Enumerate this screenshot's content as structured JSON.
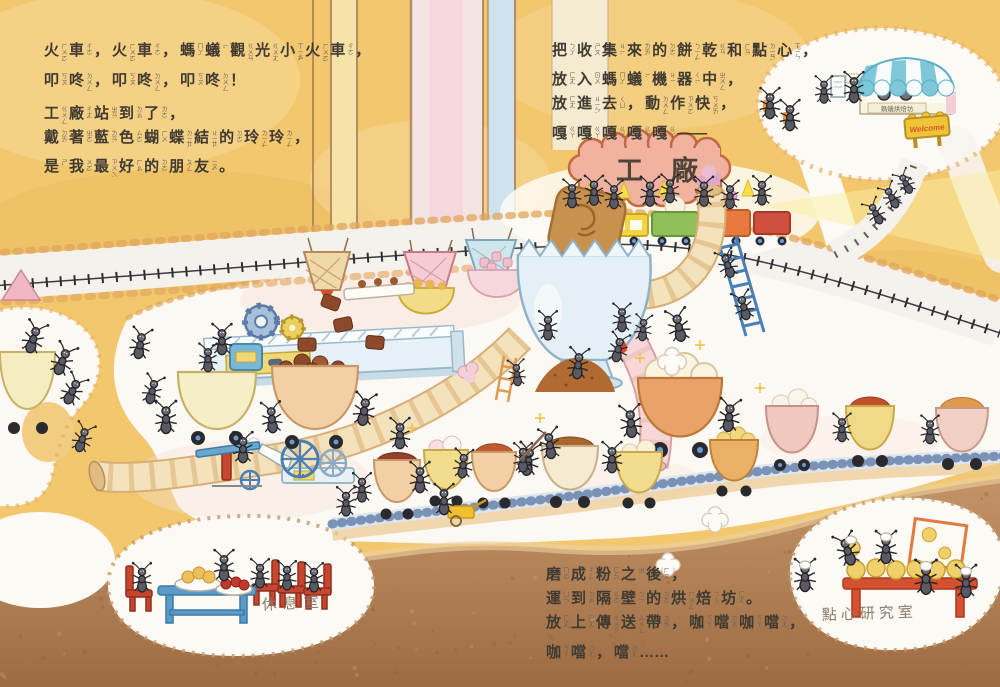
{
  "story": {
    "block1": {
      "lines": [
        [
          [
            "火",
            "ㄏㄨㄛˇ"
          ],
          [
            "車",
            "ㄔㄜ"
          ],
          [
            "，",
            ""
          ],
          [
            "火",
            "ㄏㄨㄛˇ"
          ],
          [
            "車",
            "ㄔㄜ"
          ],
          [
            "，",
            ""
          ],
          [
            "螞",
            "ㄇㄚˇ"
          ],
          [
            "蟻",
            "ㄧˇ"
          ],
          [
            "觀",
            "ㄍㄨㄢ"
          ],
          [
            "光",
            "ㄍㄨㄤ"
          ],
          [
            "小",
            "ㄒㄧㄠˇ"
          ],
          [
            "火",
            "ㄏㄨㄛˇ"
          ],
          [
            "車",
            "ㄔㄜ"
          ],
          [
            "，",
            ""
          ]
        ],
        [
          [
            "叩",
            "ㄎㄡˋ"
          ],
          [
            "咚",
            "ㄉㄨㄥ"
          ],
          [
            "，",
            ""
          ],
          [
            "叩",
            "ㄎㄡˋ"
          ],
          [
            "咚",
            "ㄉㄨㄥ"
          ],
          [
            "，",
            ""
          ],
          [
            "叩",
            "ㄎㄡˋ"
          ],
          [
            "咚",
            "ㄉㄨㄥ"
          ],
          [
            "！",
            ""
          ]
        ],
        [
          [
            "工",
            "ㄍㄨㄥ"
          ],
          [
            "廠",
            "ㄔㄤˇ"
          ],
          [
            "站",
            "ㄓㄢˋ"
          ],
          [
            "到",
            "ㄉㄠˋ"
          ],
          [
            "了",
            "ㄌㄜ˙"
          ],
          [
            "，",
            ""
          ]
        ],
        [
          [
            "戴",
            "ㄉㄞˋ"
          ],
          [
            "著",
            "ㄓㄜ˙"
          ],
          [
            "藍",
            "ㄌㄢˊ"
          ],
          [
            "色",
            "ㄙㄜˋ"
          ],
          [
            "蝴",
            "ㄏㄨˊ"
          ],
          [
            "蝶",
            "ㄉㄧㄝˊ"
          ],
          [
            "結",
            "ㄐㄧㄝˊ"
          ],
          [
            "的",
            "ㄉㄜ˙"
          ],
          [
            "玲",
            "ㄌㄧㄥˊ"
          ],
          [
            "玲",
            "ㄌㄧㄥˊ"
          ],
          [
            "，",
            ""
          ]
        ],
        [
          [
            "是",
            "ㄕˋ"
          ],
          [
            "我",
            "ㄨㄛˇ"
          ],
          [
            "最",
            "ㄗㄨㄟˋ"
          ],
          [
            "好",
            "ㄏㄠˇ"
          ],
          [
            "的",
            "ㄉㄜ˙"
          ],
          [
            "朋",
            "ㄆㄥˊ"
          ],
          [
            "友",
            "ㄧㄡˇ"
          ],
          [
            "。",
            ""
          ]
        ]
      ]
    },
    "block2": {
      "lines": [
        [
          [
            "把",
            "ㄅㄚˇ"
          ],
          [
            "收",
            "ㄕㄡ"
          ],
          [
            "集",
            "ㄐㄧˊ"
          ],
          [
            "來",
            "ㄌㄞˊ"
          ],
          [
            "的",
            "ㄉㄜ˙"
          ],
          [
            "餅",
            "ㄅㄧㄥˇ"
          ],
          [
            "乾",
            "ㄍㄢ"
          ],
          [
            "和",
            "ㄏㄢˋ"
          ],
          [
            "點",
            "ㄉㄧㄢˇ"
          ],
          [
            "心",
            "ㄒㄧㄣ"
          ],
          [
            "，",
            ""
          ]
        ],
        [
          [
            "放",
            "ㄈㄤˋ"
          ],
          [
            "入",
            "ㄖㄨˋ"
          ],
          [
            "螞",
            "ㄇㄚˇ"
          ],
          [
            "蟻",
            "ㄧˇ"
          ],
          [
            "機",
            "ㄐㄧ"
          ],
          [
            "器",
            "ㄑㄧˋ"
          ],
          [
            "中",
            "ㄓㄨㄥ"
          ],
          [
            "，",
            ""
          ]
        ],
        [
          [
            "放",
            "ㄈㄤˋ"
          ],
          [
            "進",
            "ㄐㄧㄣˋ"
          ],
          [
            "去",
            "ㄑㄩˋ"
          ],
          [
            "，",
            ""
          ],
          [
            "動",
            "ㄉㄨㄥˋ"
          ],
          [
            "作",
            "ㄗㄨㄛˋ"
          ],
          [
            "快",
            "ㄎㄨㄞˋ"
          ],
          [
            "，",
            ""
          ]
        ],
        [
          [
            "嘎",
            "ㄍㄚ"
          ],
          [
            "嘎",
            "ㄍㄚ"
          ],
          [
            "嘎",
            "ㄍㄚ"
          ],
          [
            "嘎",
            "ㄍㄚ"
          ],
          [
            "嘎",
            "ㄍㄚ"
          ],
          [
            "——",
            ""
          ]
        ]
      ]
    },
    "block3": {
      "lines": [
        [
          [
            "磨",
            "ㄇㄛˊ"
          ],
          [
            "成",
            "ㄔㄥˊ"
          ],
          [
            "粉",
            "ㄈㄣˇ"
          ],
          [
            "之",
            "ㄓ"
          ],
          [
            "後",
            "ㄏㄡˋ"
          ],
          [
            "，",
            ""
          ]
        ],
        [
          [
            "運",
            "ㄩㄣˋ"
          ],
          [
            "到",
            "ㄉㄠˋ"
          ],
          [
            "隔",
            "ㄍㄜˊ"
          ],
          [
            "壁",
            "ㄅㄧˋ"
          ],
          [
            "的",
            "ㄉㄜ˙"
          ],
          [
            "烘",
            "ㄏㄨㄥ"
          ],
          [
            "焙",
            "ㄅㄟˋ"
          ],
          [
            "坊",
            "ㄈㄤ"
          ],
          [
            "。",
            ""
          ]
        ],
        [
          [
            "放",
            "ㄈㄤˋ"
          ],
          [
            "上",
            "ㄕㄤˋ"
          ],
          [
            "傳",
            "ㄔㄨㄢˊ"
          ],
          [
            "送",
            "ㄙㄨㄥˋ"
          ],
          [
            "帶",
            "ㄉㄞˋ"
          ],
          [
            "，",
            ""
          ],
          [
            "咖",
            "ㄎㄚ"
          ],
          [
            "噹",
            "ㄉㄤ"
          ],
          [
            "咖",
            "ㄎㄚ"
          ],
          [
            "噹",
            "ㄉㄤ"
          ],
          [
            "，",
            ""
          ]
        ],
        [
          [
            "咖",
            "ㄎㄚ"
          ],
          [
            "噹",
            "ㄉㄤ"
          ],
          [
            "，",
            ""
          ],
          [
            "噹",
            "ㄉㄤ"
          ],
          [
            "……",
            ""
          ]
        ]
      ]
    }
  },
  "labels": {
    "factory_sign": "工廠",
    "rest_room": "休息室",
    "research_room": "點心研究室",
    "shop_sign": "螞蟻烘焙坊",
    "welcome_sign": "Welcome"
  },
  "palette": {
    "ground_gold": "#f2c76e",
    "soil_brown": "#a5754a",
    "tunnel_white": "#fcf8f3",
    "factory_sign_pink": "#f1b3a0",
    "machine_blue": "#e6f2f7",
    "ladder_blue": "#4a7fb5",
    "chair_red": "#c8452e",
    "table_blue": "#5b9bc8",
    "table_red": "#d4502e",
    "awning_blue": "#7fc8da",
    "welcome_yellow": "#f0c43a"
  }
}
